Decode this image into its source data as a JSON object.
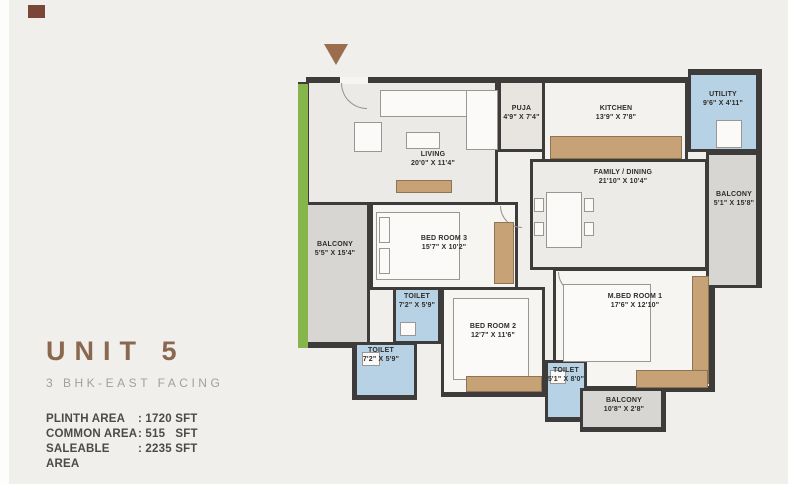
{
  "page": {
    "background": "#f1efeb"
  },
  "branding": {
    "logo_square_color": "#7b4637"
  },
  "unit_info": {
    "title": "UNIT 5",
    "subtitle": "3 BHK-EAST FACING",
    "areas": [
      {
        "label": "PLINTH AREA",
        "value": ": 1720 SFT"
      },
      {
        "label": "COMMON AREA",
        "value": ": 515   SFT"
      },
      {
        "label": "SALEABLE AREA",
        "value": ": 2235 SFT"
      }
    ]
  },
  "floor_plan": {
    "entry_arrow": "entry-direction-arrow",
    "colors": {
      "wall": "#3e3c3a",
      "balcony_green_edge": "#86b54b",
      "wet_area_blue": "#b7d2e4",
      "balcony_gray": "#d8d6d2",
      "furniture_tan": "#c6a276",
      "accent_brown": "#8a6850"
    },
    "rooms": [
      {
        "id": "living",
        "name": "LIVING",
        "dims": "20'0\" X 11'4\""
      },
      {
        "id": "puja",
        "name": "PUJA",
        "dims": "4'9\" X 7'4\""
      },
      {
        "id": "kitchen",
        "name": "KITCHEN",
        "dims": "13'9\" X 7'8\""
      },
      {
        "id": "utility",
        "name": "UTILITY",
        "dims": "9'6\" X 4'11\""
      },
      {
        "id": "family-dining",
        "name": "FAMILY / DINING",
        "dims": "21'10\" X 10'4\""
      },
      {
        "id": "balcony-right",
        "name": "BALCONY",
        "dims": "5'1\" X 15'8\""
      },
      {
        "id": "bedroom-3",
        "name": "BED ROOM 3",
        "dims": "15'7\" X 10'2\""
      },
      {
        "id": "balcony-left",
        "name": "BALCONY",
        "dims": "5'5\" X 15'4\""
      },
      {
        "id": "toilet-top",
        "name": "TOILET",
        "dims": "7'2\" X 5'9\""
      },
      {
        "id": "bedroom-2",
        "name": "BED ROOM 2",
        "dims": "12'7\" X 11'6\""
      },
      {
        "id": "master-bedroom",
        "name": "M.BED ROOM 1",
        "dims": "17'6\" X 12'10\""
      },
      {
        "id": "toilet-left",
        "name": "TOILET",
        "dims": "7'2\" X 5'9\""
      },
      {
        "id": "toilet-bottom",
        "name": "TOILET",
        "dims": "5'1\" X 8'0\""
      },
      {
        "id": "balcony-bottom",
        "name": "BALCONY",
        "dims": "10'8\" X 2'8\""
      }
    ]
  }
}
